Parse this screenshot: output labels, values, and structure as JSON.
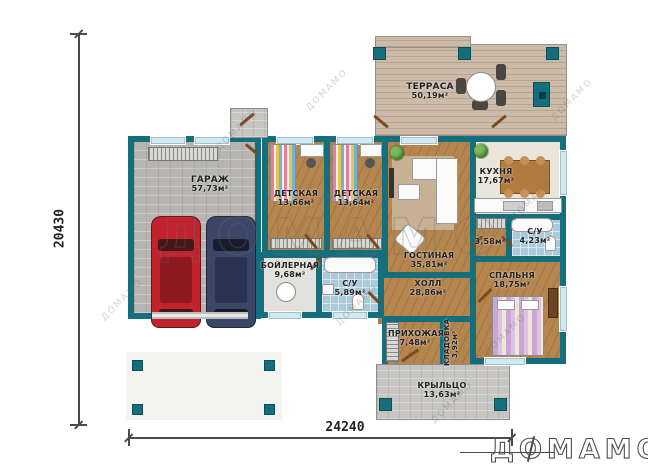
{
  "plan": {
    "watermark": "ДОМАМО",
    "logo": "ДОМАМО",
    "dimensions": {
      "left": "20430",
      "bottom": "24240"
    },
    "rooms": {
      "terrace": {
        "name": "ТЕРРАСА",
        "area": "50,19м²"
      },
      "garage": {
        "name": "ГАРАЖ",
        "area": "57,73м²"
      },
      "child1": {
        "name": "ДЕТСКАЯ",
        "area": "13,66м²"
      },
      "child2": {
        "name": "ДЕТСКАЯ",
        "area": "13,64м²"
      },
      "kitchen": {
        "name": "КУХНЯ",
        "area": "17,67м²"
      },
      "living": {
        "name": "ГОСТИНАЯ",
        "area": "35,81м²"
      },
      "boiler": {
        "name": "БОЙЛЕРНАЯ",
        "area": "9,68м²"
      },
      "bath1": {
        "name": "С/У",
        "area": "5,89м²"
      },
      "bath2": {
        "name": "С/У",
        "area": "4,23м²"
      },
      "wardrobe": {
        "name": "",
        "area": "3,58м²"
      },
      "bedroom": {
        "name": "СПАЛЬНЯ",
        "area": "18,75м²"
      },
      "hall": {
        "name": "ХОЛЛ",
        "area": "28,86м²"
      },
      "entry": {
        "name": "ПРИХОЖАЯ",
        "area": "7,48м²"
      },
      "storage": {
        "name": "КЛАДОВКА",
        "area": "3,92м²"
      },
      "porch": {
        "name": "КРЫЛЬЦО",
        "area": "13,63м²"
      }
    },
    "colors": {
      "wall": "#156e7b",
      "car_red": "#c0232e",
      "car_blue": "#3c4666"
    }
  }
}
